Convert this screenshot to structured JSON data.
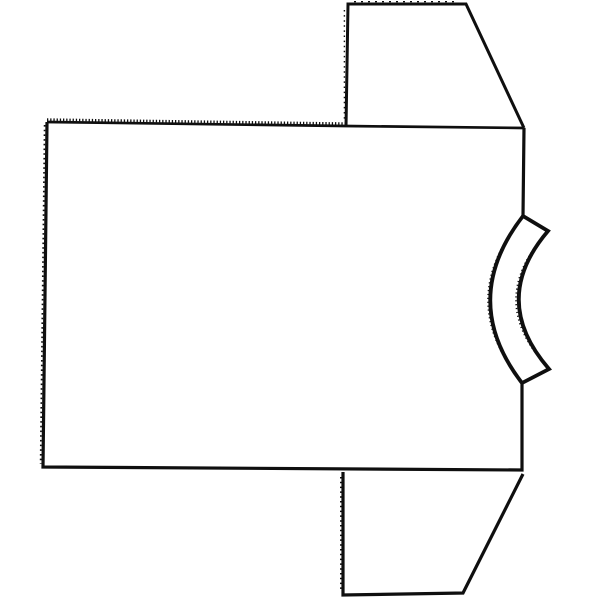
{
  "canvas": {
    "width": 600,
    "height": 600,
    "background": "#ffffff",
    "stroke_color": "#0f0f0f"
  },
  "drawing": {
    "description": "Black-and-white line drawing of a short-sleeved t-shirt rotated 90 degrees, collar band on the right side, sleeves pointing up and down on the right, large rectangular body on the left; left body edge and upper body edge have rough serrated/stitched texture",
    "shapes": [
      {
        "name": "shirt-body-top-edge",
        "d": "M 47,122 L 345,126 L 524,128",
        "stroke_width": 2.7,
        "dash": ""
      },
      {
        "name": "shirt-body-top-edge-serration",
        "d": "M 47,119.6 L 345,123.6",
        "stroke_width": 2.6,
        "dash": "1.3 1.9"
      },
      {
        "name": "shirt-body-outline",
        "d": "M 524,128 L 523,216 M 522,383 L 522,470 L 43,467 L 47,122",
        "stroke_width": 3.2,
        "dash": ""
      },
      {
        "name": "shirt-body-left-edge-texture",
        "d": "M 44.6,125 L 40.6,464",
        "stroke_width": 1.7,
        "dash": "1.6 3.1"
      },
      {
        "name": "top-sleeve-outline",
        "d": "M 346,127 L 348,4 L 466,4 L 524,128",
        "stroke_width": 3.0,
        "dash": ""
      },
      {
        "name": "top-sleeve-top-edge-texture",
        "d": "M 354,1.6 L 458,1.6",
        "stroke_width": 1.2,
        "dash": "2 5"
      },
      {
        "name": "top-sleeve-left-edge-texture",
        "d": "M 344.4,10 L 344.4,122",
        "stroke_width": 1.4,
        "dash": "1.5 3.6"
      },
      {
        "name": "bottom-sleeve-outline",
        "d": "M 343,472 L 343,595 L 463,593 L 523,474",
        "stroke_width": 3.2,
        "dash": ""
      },
      {
        "name": "bottom-sleeve-left-edge-texture",
        "d": "M 340.8,477 L 340.8,592",
        "stroke_width": 1.6,
        "dash": "1.5 3.3"
      },
      {
        "name": "collar-band-outline",
        "d": "M 523,216 L 548,231 Q 489,300 549,369 L 522,383 Q 458,300 523,216 Z",
        "stroke_width": 3.8,
        "dash": ""
      },
      {
        "name": "collar-outer-edge-fuzz",
        "d": "M 520.5,220 Q 456,300 519.5,379",
        "stroke_width": 1.6,
        "dash": "1.2 2.7"
      },
      {
        "name": "collar-inner-edge-fuzz",
        "d": "M 545.5,234 Q 486,301 546.5,366",
        "stroke_width": 1.6,
        "dash": "1.2 2.7"
      }
    ]
  }
}
